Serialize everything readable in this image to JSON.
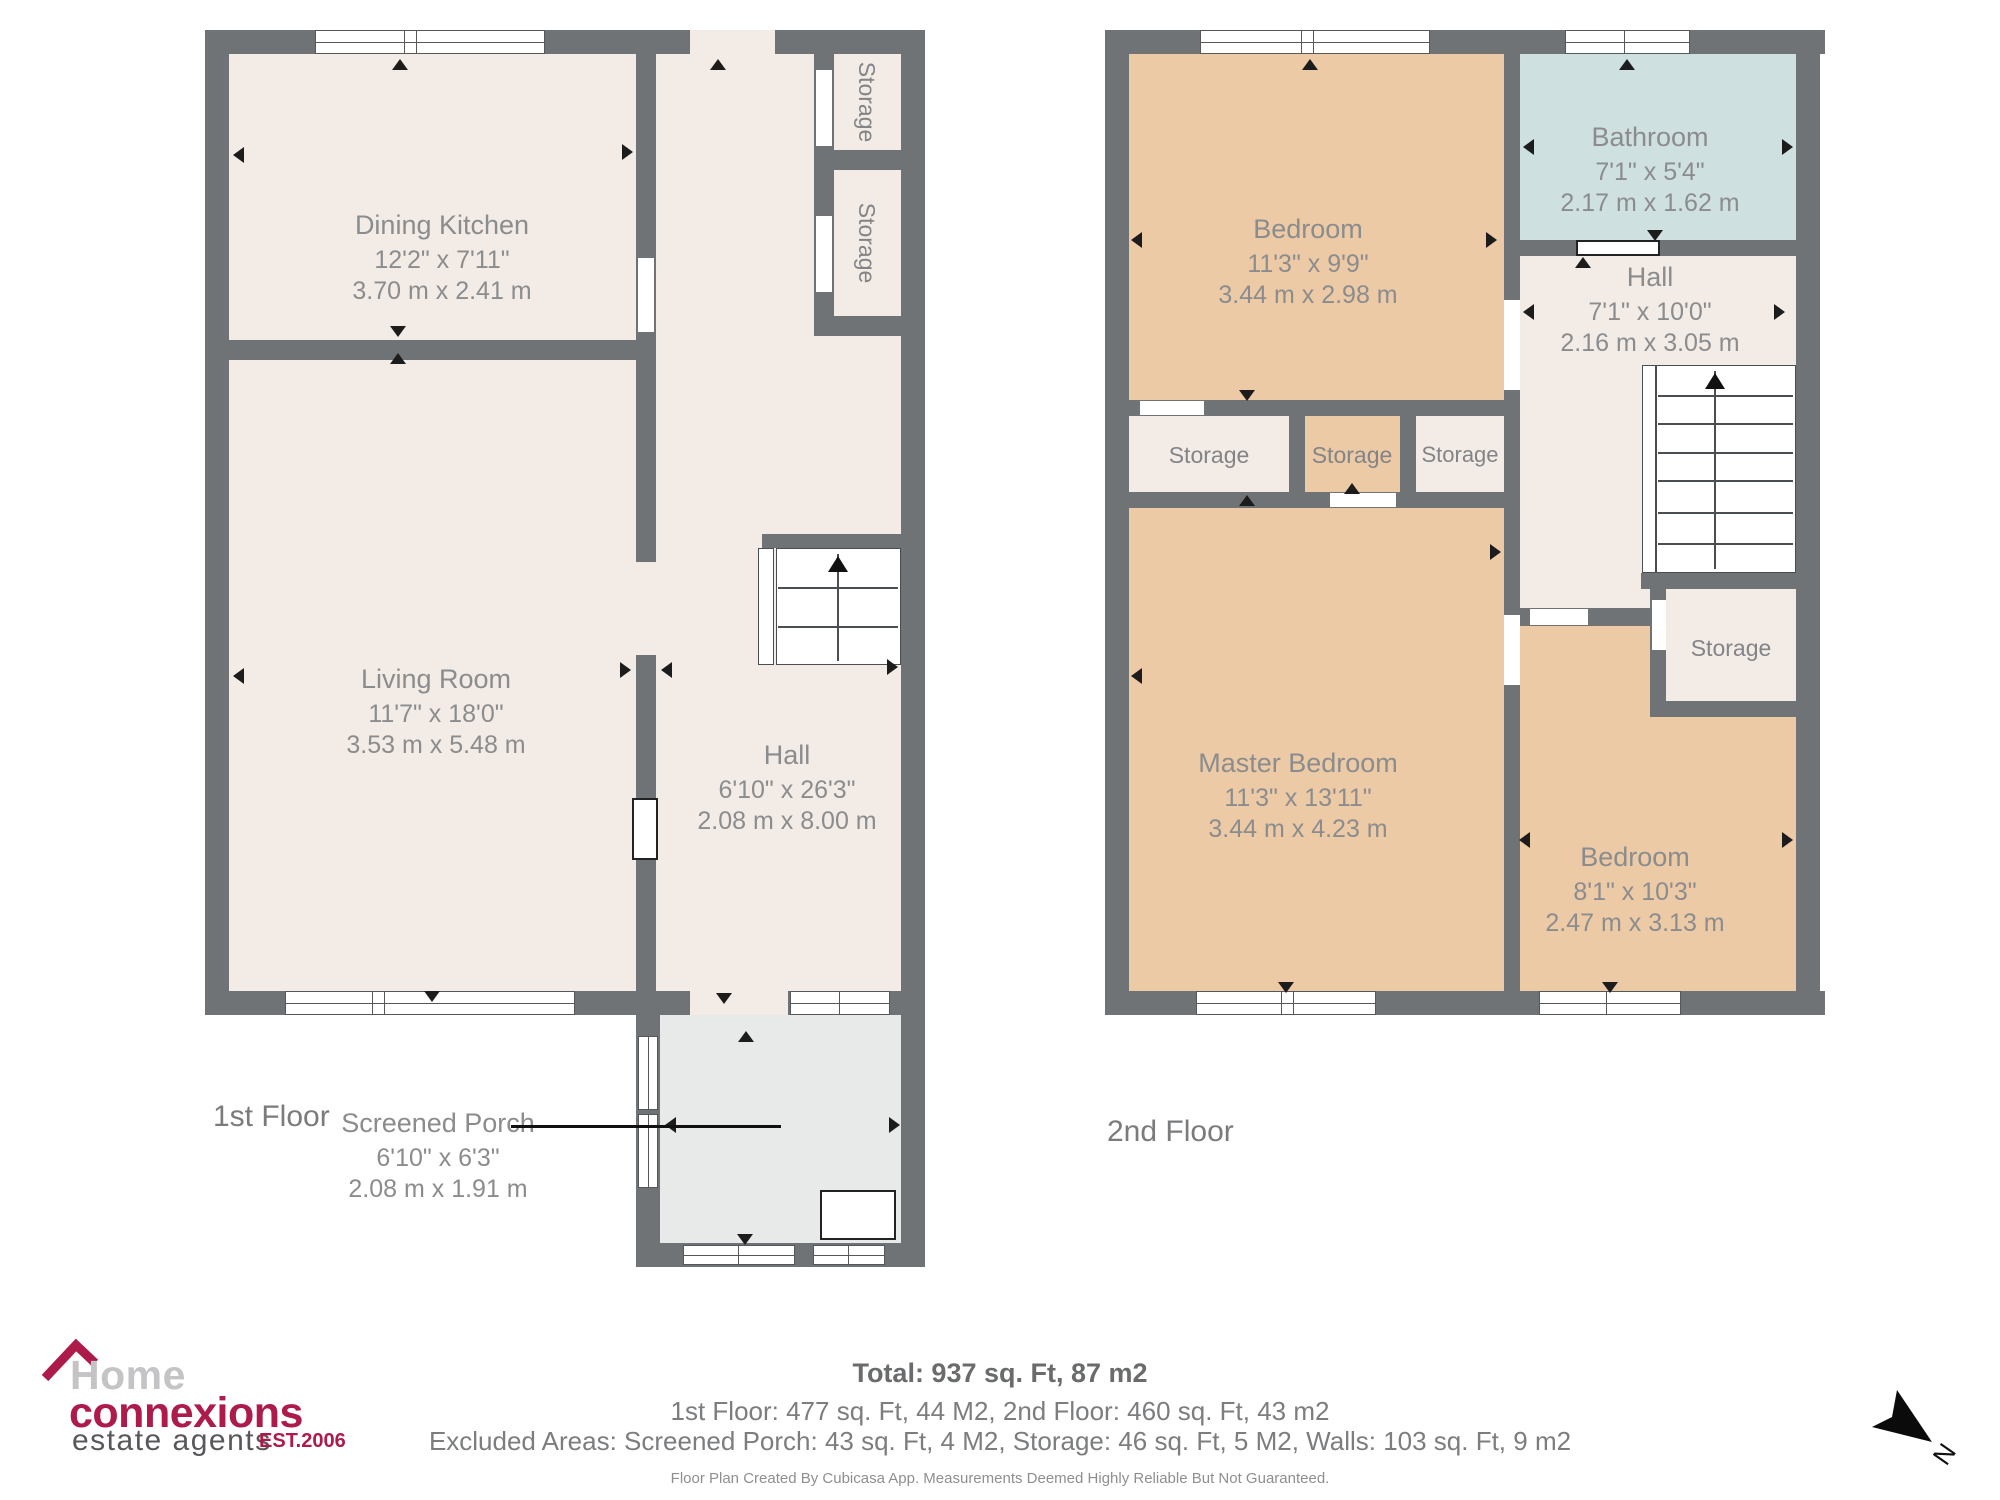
{
  "colors": {
    "wall": "#707375",
    "room_fill": "#f3ece6",
    "bedroom_fill": "#eccaa5",
    "bathroom_fill": "#cfe0e0",
    "porch_fill": "#e8eaea",
    "brand_crimson": "#ad1b4a"
  },
  "floor1": {
    "label": "1st Floor",
    "rooms": [
      {
        "name": "Dining Kitchen",
        "dims_ft": "12'2\" x 7'11\"",
        "dims_m": "3.70 m x 2.41 m"
      },
      {
        "name": "Living Room",
        "dims_ft": "11'7\" x 18'0\"",
        "dims_m": "3.53 m x 5.48 m"
      },
      {
        "name": "Hall",
        "dims_ft": "6'10\" x 26'3\"",
        "dims_m": "2.08 m x 8.00 m"
      },
      {
        "name": "Storage"
      },
      {
        "name": "Storage"
      },
      {
        "name": "Screened Porch",
        "dims_ft": "6'10\" x 6'3\"",
        "dims_m": "2.08 m x 1.91 m"
      }
    ]
  },
  "floor2": {
    "label": "2nd Floor",
    "rooms": [
      {
        "name": "Bedroom",
        "dims_ft": "11'3\" x 9'9\"",
        "dims_m": "3.44 m x 2.98 m"
      },
      {
        "name": "Bathroom",
        "dims_ft": "7'1\" x 5'4\"",
        "dims_m": "2.17 m x 1.62 m"
      },
      {
        "name": "Hall",
        "dims_ft": "7'1\" x 10'0\"",
        "dims_m": "2.16 m x 3.05 m"
      },
      {
        "name": "Storage"
      },
      {
        "name": "Storage"
      },
      {
        "name": "Storage"
      },
      {
        "name": "Master Bedroom",
        "dims_ft": "11'3\" x 13'11\"",
        "dims_m": "3.44 m x 4.23 m"
      },
      {
        "name": "Bedroom",
        "dims_ft": "8'1\" x 10'3\"",
        "dims_m": "2.47 m x 3.13 m"
      },
      {
        "name": "Storage"
      }
    ]
  },
  "summary": {
    "total": "Total: 937 sq. Ft, 87 m2",
    "floors": "1st Floor: 477 sq. Ft, 44 M2, 2nd Floor: 460 sq. Ft, 43 m2",
    "excluded": "Excluded Areas: Screened Porch: 43 sq. Ft, 4 M2, Storage: 46 sq. Ft, 5 M2, Walls: 103 sq. Ft, 9 m2",
    "disclaimer": "Floor Plan Created By Cubicasa App. Measurements Deemed Highly Reliable But Not Guaranteed."
  },
  "logo": {
    "word1": "Home",
    "word2": "connexions",
    "word3": "estate agents",
    "established": "EST.2006"
  },
  "compass": {
    "north_label": "N"
  }
}
